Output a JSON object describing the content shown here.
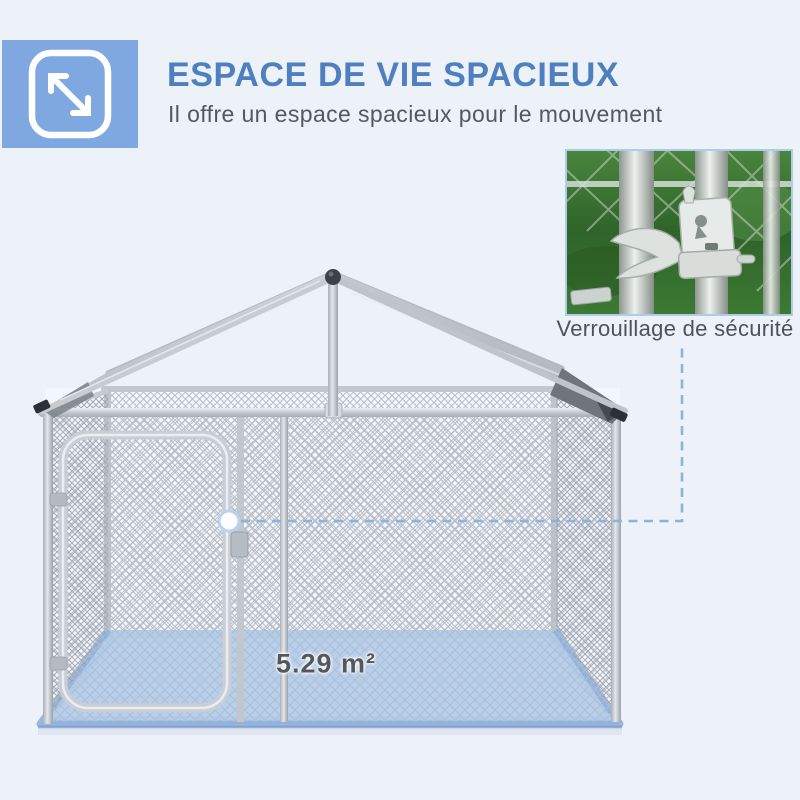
{
  "page": {
    "background": "#edf1f8"
  },
  "header": {
    "icon": "expand-arrows-icon",
    "icon_bg": "#7ea8df",
    "title": "ESPACE DE VIE SPACIEUX",
    "title_color": "#4e80c0",
    "subtitle": "Il offre un espace spacieux pour le mouvement",
    "subtitle_color": "#55595e"
  },
  "callout": {
    "label": "Verrouillage de sécurité",
    "connector_color": "#8cb2de",
    "image": "security-latch-photo"
  },
  "product": {
    "floor_area_label": "5.29 m²",
    "floor_color": "#aac8ec",
    "frame_color": "#c9ced4",
    "tarp_color": "#c4c8ce"
  }
}
